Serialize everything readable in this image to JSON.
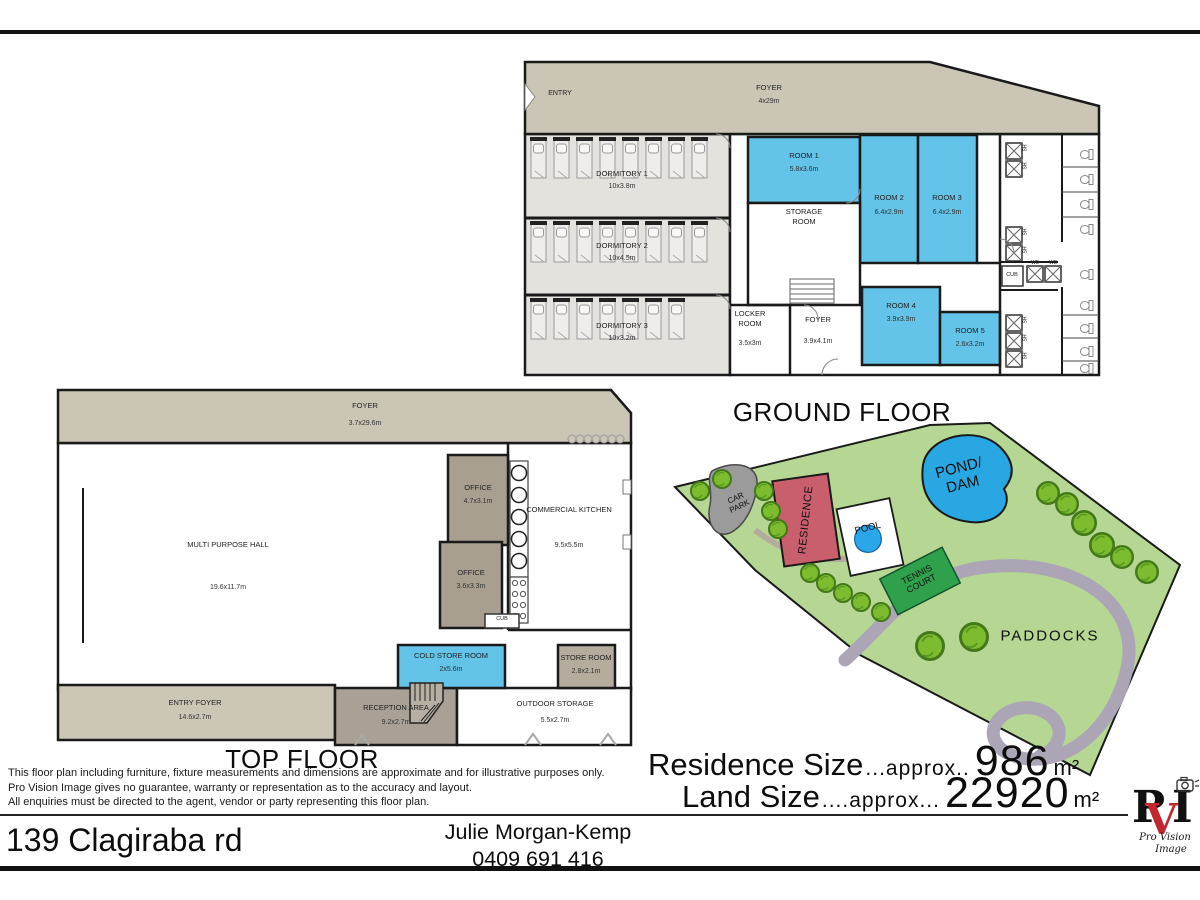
{
  "titles": {
    "ground_floor": "GROUND FLOOR",
    "top_floor": "TOP FLOOR"
  },
  "ground_floor": {
    "entry": "ENTRY",
    "foyer": {
      "name": "FOYER",
      "dims": "4x29m"
    },
    "dormitories": [
      {
        "name": "DORMITORY 1",
        "dims": "10x3.8m"
      },
      {
        "name": "DORMITORY 2",
        "dims": "10x4.5m"
      },
      {
        "name": "DORMITORY 3",
        "dims": "10x3.2m"
      }
    ],
    "rooms": [
      {
        "name": "ROOM 1",
        "dims": "5.8x3.6m"
      },
      {
        "name": "ROOM 2",
        "dims": "6.4x2.9m"
      },
      {
        "name": "ROOM 3",
        "dims": "6.4x2.9m"
      },
      {
        "name": "ROOM 4",
        "dims": "3.9x3.9m"
      },
      {
        "name": "ROOM 5",
        "dims": "2.6x3.2m"
      }
    ],
    "storage_room": {
      "name": "STORAGE ROOM"
    },
    "locker_room": {
      "name": "LOCKER ROOM",
      "dims": "3.5x3m"
    },
    "inner_foyer": {
      "name": "FOYER",
      "dims": "3.9x4.1m"
    },
    "cub": "CUB",
    "shower": "SH",
    "basin": "WB"
  },
  "top_floor": {
    "foyer": {
      "name": "FOYER",
      "dims": "3.7x29.6m"
    },
    "hall": {
      "name": "MULTI PURPOSE HALL",
      "dims": "19.6x11.7m"
    },
    "office_1": {
      "name": "OFFICE",
      "dims": "4.7x3.1m"
    },
    "office_2": {
      "name": "OFFICE",
      "dims": "3.6x3.3m"
    },
    "kitchen": {
      "name": "COMMERCIAL KITCHEN",
      "dims": "9.5x5.5m"
    },
    "cub": "CUB",
    "cold_store": {
      "name": "COLD STORE ROOM",
      "dims": "2x5.6m"
    },
    "store_room": {
      "name": "STORE ROOM",
      "dims": "2.8x2.1m"
    },
    "entry_foyer": {
      "name": "ENTRY FOYER",
      "dims": "14.6x2.7m"
    },
    "reception": {
      "name": "RECEPTION AREA",
      "dims": "9.2x2.7m"
    },
    "outdoor_storage": {
      "name": "OUTDOOR STORAGE",
      "dims": "5.5x2.7m"
    }
  },
  "site_plan": {
    "car_park": "CAR PARK",
    "residence": "RESIDENCE",
    "pool": "POOL",
    "pond": "POND/ DAM",
    "tennis_court": "TENNIS COURT",
    "paddocks": "PADDOCKS"
  },
  "sizes": {
    "residence": {
      "label": "Residence Size",
      "approx": "...approx..",
      "value": "986",
      "unit": "m²"
    },
    "land": {
      "label": "Land Size",
      "approx": "....approx...",
      "value": "22920",
      "unit": "m²"
    }
  },
  "disclaimer": {
    "line1": "This floor plan including furniture, fixture measurements and dimensions are approximate and for illustrative purposes only.",
    "line2": "Pro Vision Image gives no guarantee, warranty or representation as to the accuracy and layout.",
    "line3": "All enquiries must be directed to the agent, vendor or party representing this floor plan."
  },
  "footer": {
    "address": "139 Clagiraba rd",
    "agent_name": "Julie Morgan-Kemp",
    "agent_phone": "0409 691 416"
  },
  "logo": {
    "letter_p": "P",
    "letter_v": "V",
    "letter_i": "I",
    "text_top": "Pro Vision",
    "text_bottom": "Image"
  },
  "colors": {
    "room_blue": "#63c3e8",
    "floor_tan": "#cbc5b6",
    "office_tan": "#a89f90",
    "land_green": "#b5d793",
    "pond_blue": "#29a7e2",
    "residence_red": "#c95f6d",
    "tennis_green": "#2fa04c",
    "track_grey": "#aba5b5",
    "logo_red": "#c1272d"
  }
}
